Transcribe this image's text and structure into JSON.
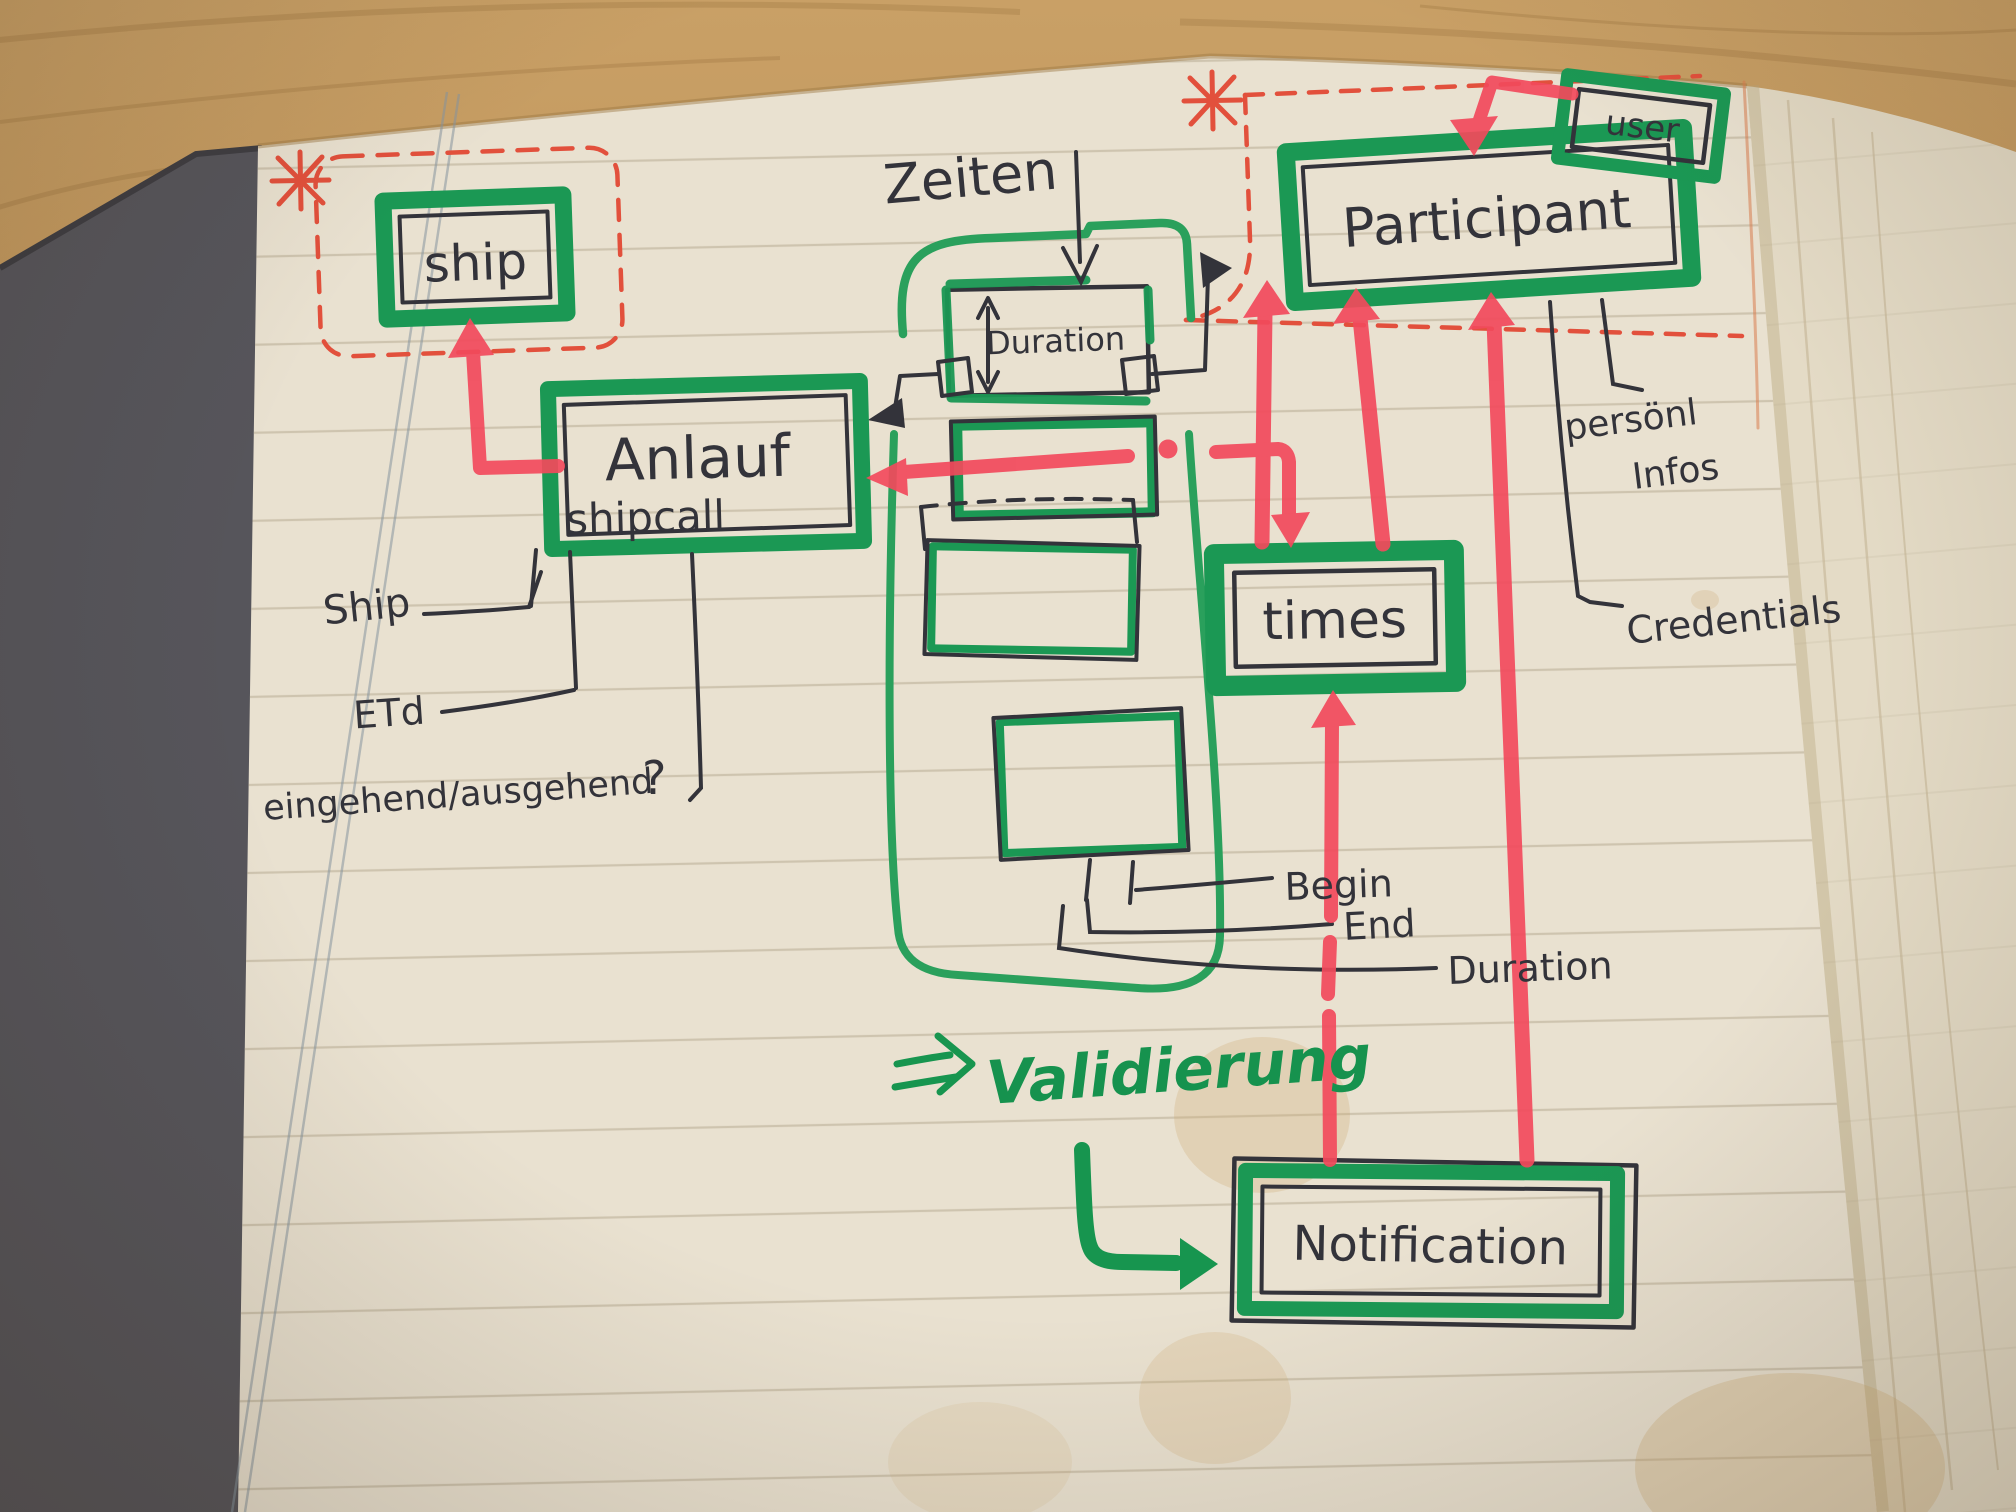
{
  "diagram": {
    "entities": {
      "ship": {
        "label": "ship"
      },
      "anlauf": {
        "label": "Anlauf",
        "sublabel": "shipcall"
      },
      "duration_box": {
        "label": "Duration"
      },
      "participant": {
        "label": "Participant"
      },
      "user": {
        "label": "user"
      },
      "times": {
        "label": "times"
      },
      "notification": {
        "label": "Notification"
      }
    },
    "annotations": {
      "zeiten": "Zeiten",
      "ship_attr": "Ship",
      "eta": "ETd",
      "in_out": "eingehend/ausgehend",
      "question_mark": "?",
      "begin": "Begin",
      "end": "End",
      "duration_attr": "Duration",
      "personal_infos_line1": "persönl",
      "personal_infos_line2": "Infos",
      "credentials": "Credentials",
      "validierung": "Validierung",
      "asterisk_marker": "*"
    },
    "edges": [
      {
        "from": "Anlauf/shipcall",
        "to": "ship",
        "style": "red-marker-arrow"
      },
      {
        "from": "user",
        "to": "Participant",
        "style": "red-marker-arrow"
      },
      {
        "from": "times",
        "to": "Participant",
        "style": "red-marker-arrow",
        "count": 2
      },
      {
        "from": "Notification",
        "to": "times",
        "style": "red-marker-arrow"
      },
      {
        "from": "Notification",
        "to": "Participant",
        "style": "red-marker-arrow"
      },
      {
        "from": "times",
        "to": "Anlauf/shipcall",
        "style": "red-marker-arrow-bidirectional"
      },
      {
        "from": "Duration",
        "to": "Anlauf/shipcall",
        "style": "pen-connector"
      },
      {
        "from": "Duration",
        "to": "Participant",
        "style": "pen-arrow"
      },
      {
        "from": "Validierung",
        "to": "Notification",
        "style": "green-marker-arrow"
      }
    ],
    "colors": {
      "green_marker": "#1b9854",
      "red_marker": "#f24a5c",
      "red_pen": "#e2503c",
      "ink": "#33333a",
      "paper": "#e9e1d0",
      "wood": "#bf955c",
      "cover": "#56555b"
    }
  }
}
